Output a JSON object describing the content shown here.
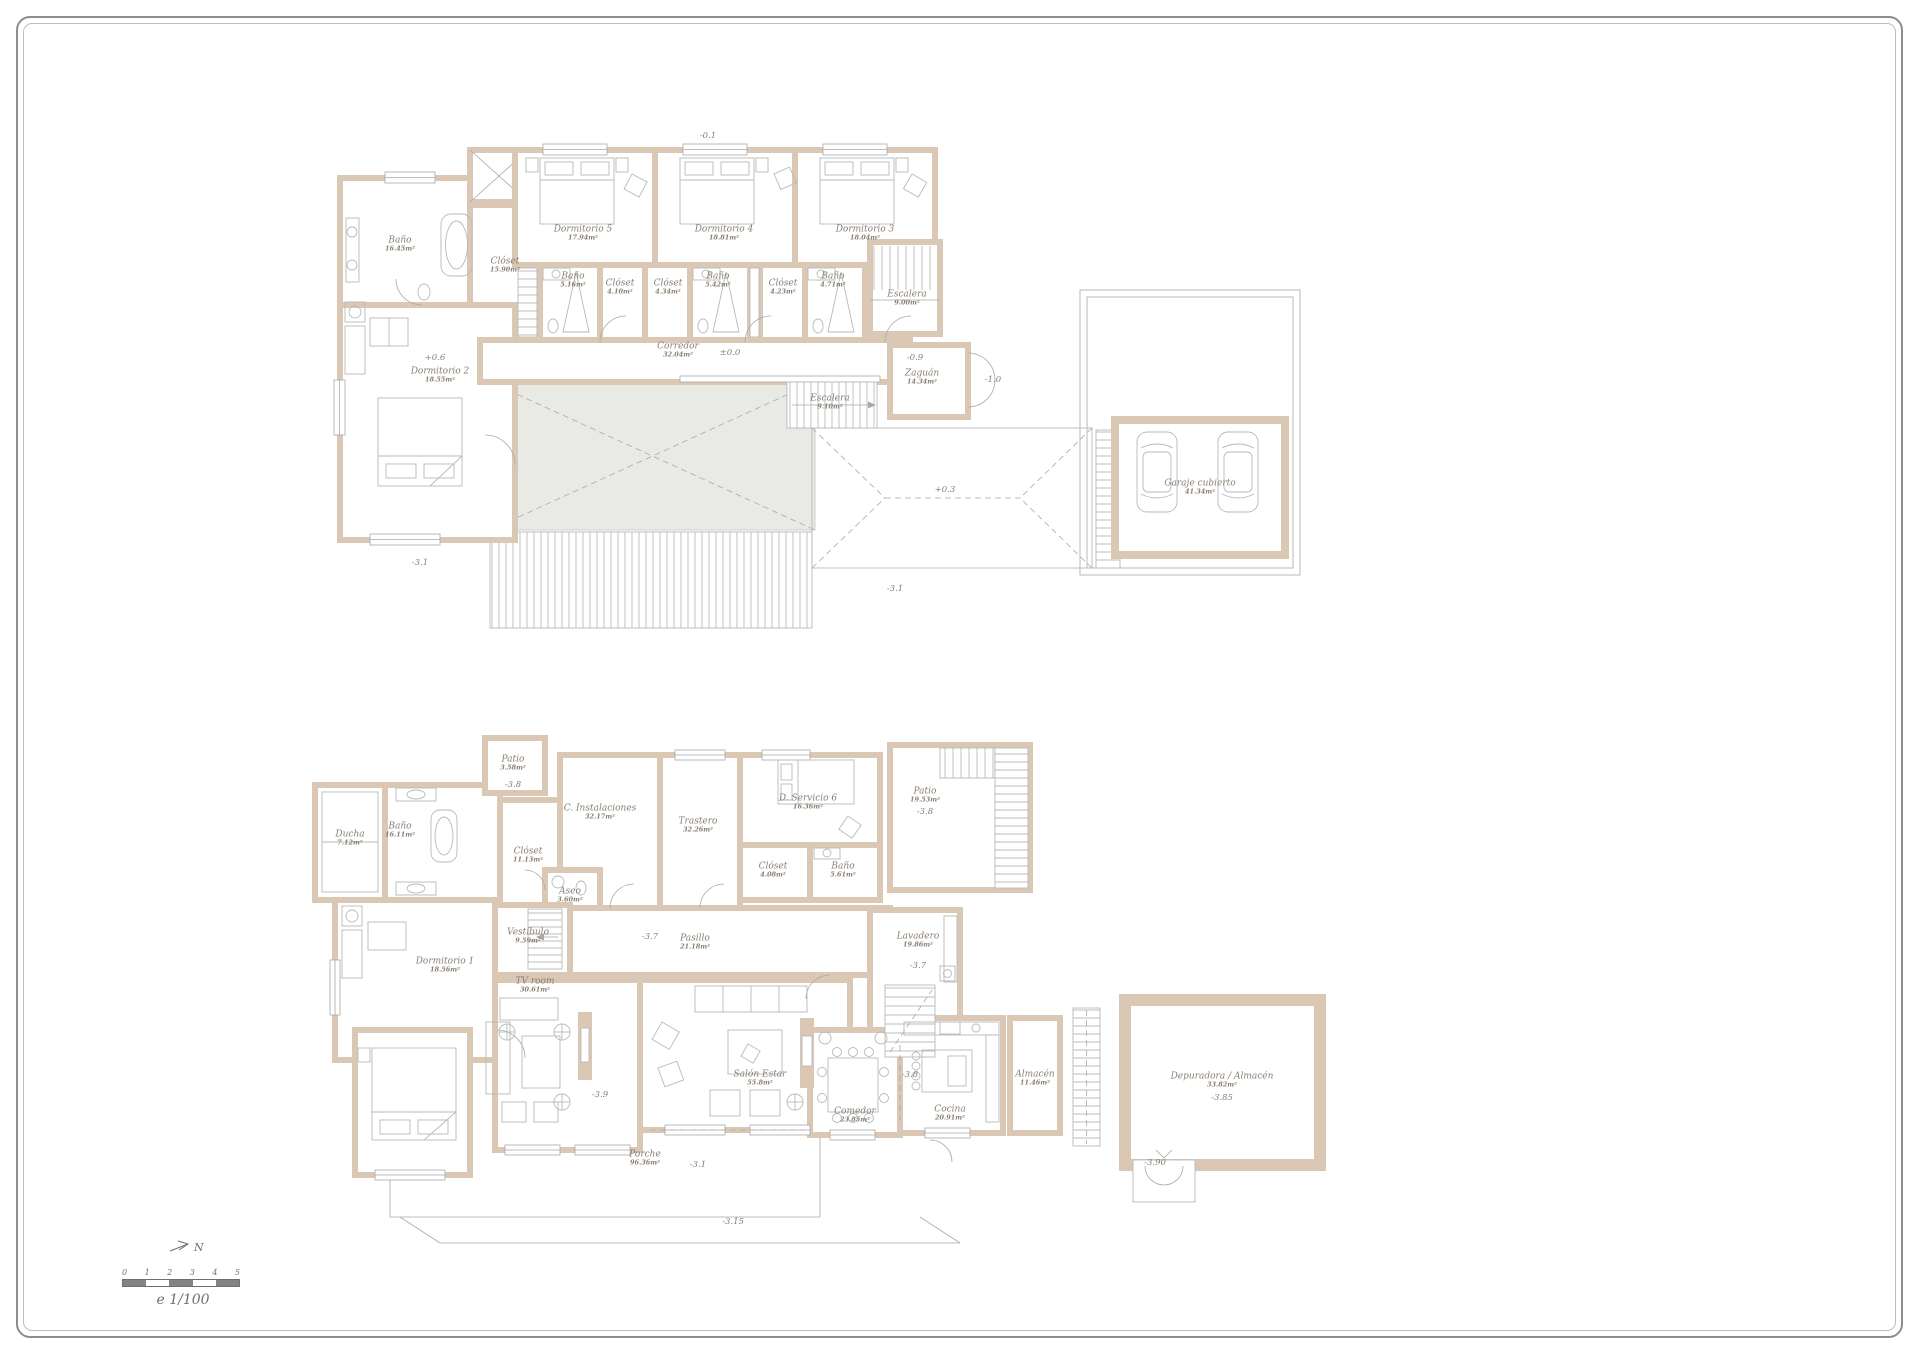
{
  "frame": {
    "north_label": "N",
    "scale_ticks": [
      "0",
      "1",
      "2",
      "3",
      "4",
      "5"
    ],
    "scale_label": "e 1/100"
  },
  "colors": {
    "wall": "#dac7b4",
    "line": "#a9a9a9",
    "text": "#877e72",
    "terrace": "#e9e9e6"
  },
  "upper_floor": {
    "rooms": [
      {
        "name": "Baño",
        "area": "16.45m²"
      },
      {
        "name": "Clóset",
        "area": "15.90m²"
      },
      {
        "name": "Dormitorio 2",
        "area": "18.55m²"
      },
      {
        "name": "Dormitorio 5",
        "area": "17.94m²"
      },
      {
        "name": "Dormitorio 4",
        "area": "18.81m²"
      },
      {
        "name": "Dormitorio 3",
        "area": "18.04m²"
      },
      {
        "name": "Baño",
        "area": "5.16m²"
      },
      {
        "name": "Clóset",
        "area": "4.10m²"
      },
      {
        "name": "Clóset",
        "area": "4.34m²"
      },
      {
        "name": "Baño",
        "area": "5.42m²"
      },
      {
        "name": "Clóset",
        "area": "4.23m²"
      },
      {
        "name": "Baño",
        "area": "4.71m²"
      },
      {
        "name": "Escalera",
        "area": "9.00m²"
      },
      {
        "name": "Corredor",
        "area": "32.04m²"
      },
      {
        "name": "Escalera",
        "area": "9.10m²"
      },
      {
        "name": "Zaguán",
        "area": "14.34m²"
      },
      {
        "name": "Garaje cubierto",
        "area": "41.34m²"
      }
    ],
    "levels": [
      "-0.1",
      "+0.6",
      "±0.0",
      "-0.9",
      "-1.0",
      "+0.3",
      "-3.1",
      "-3.1"
    ]
  },
  "lower_floor": {
    "rooms": [
      {
        "name": "Patio",
        "area": "3.58m²"
      },
      {
        "name": "Ducha",
        "area": "7.12m²"
      },
      {
        "name": "Baño",
        "area": "16.11m²"
      },
      {
        "name": "Clóset",
        "area": "11.13m²"
      },
      {
        "name": "C. Instalaciones",
        "area": "32.17m²"
      },
      {
        "name": "Trastero",
        "area": "32.26m²"
      },
      {
        "name": "D. Servicio 6",
        "area": "16.36m²"
      },
      {
        "name": "Clóset",
        "area": "4.08m²"
      },
      {
        "name": "Baño",
        "area": "5.61m²"
      },
      {
        "name": "Patio",
        "area": "19.53m²"
      },
      {
        "name": "Aseo",
        "area": "3.60m²"
      },
      {
        "name": "Vestíbulo",
        "area": "9.59m²"
      },
      {
        "name": "Pasillo",
        "area": "21.18m²"
      },
      {
        "name": "Lavadero",
        "area": "19.86m²"
      },
      {
        "name": "Dormitorio 1",
        "area": "18.56m²"
      },
      {
        "name": "TV room",
        "area": "30.61m²"
      },
      {
        "name": "Salón Estar",
        "area": "55.8m²"
      },
      {
        "name": "Comedor",
        "area": "23.85m²"
      },
      {
        "name": "Cocina",
        "area": "20.91m²"
      },
      {
        "name": "Almacén",
        "area": "11.46m²"
      },
      {
        "name": "Depuradora / Almacén",
        "area": "33.82m²"
      },
      {
        "name": "Porche",
        "area": "96.36m²"
      }
    ],
    "levels": [
      "-3.8",
      "-3.8",
      "-3.7",
      "-3.7",
      "-3.9",
      "-3.8",
      "-3.85",
      "-3.90",
      "-3.1",
      "-3.15"
    ]
  }
}
